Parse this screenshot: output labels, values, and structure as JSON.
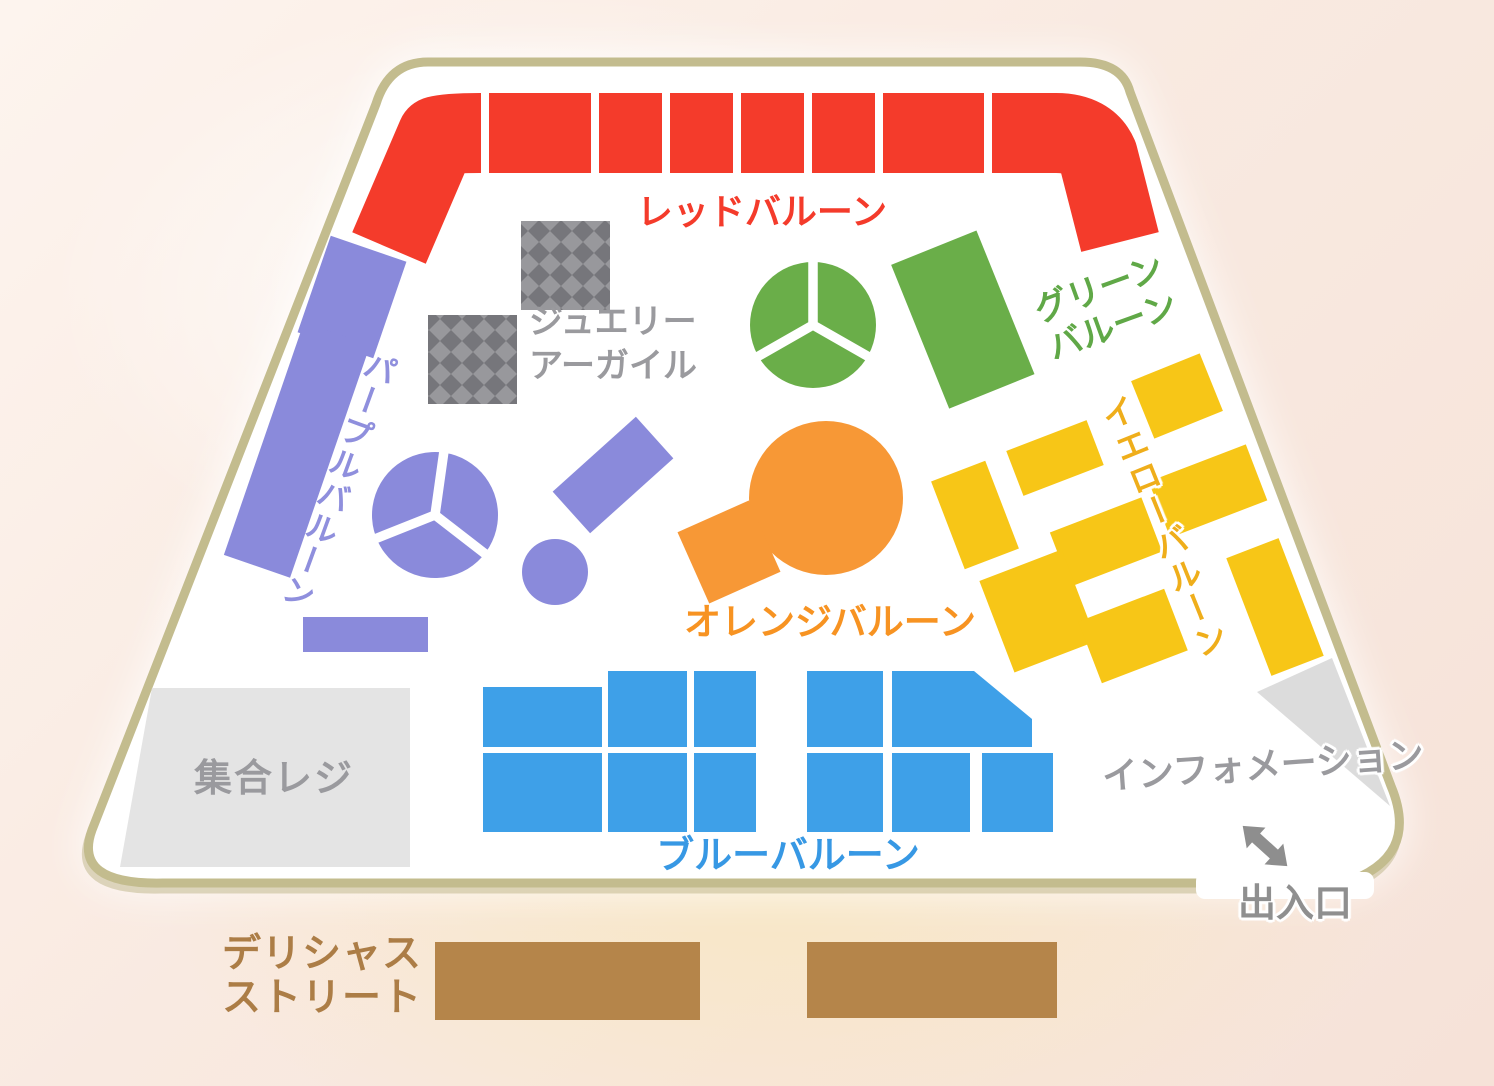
{
  "map": {
    "name": "store-floor-map",
    "zones": {
      "red": {
        "label": "レッドバルーン"
      },
      "purple": {
        "label": "パープルバルーン"
      },
      "green": {
        "label_line1": "グリーン",
        "label_line2": "バルーン"
      },
      "yellow": {
        "label": "イエローバルーン"
      },
      "orange": {
        "label": "オレンジバルーン"
      },
      "blue": {
        "label": "ブルーバルーン"
      },
      "jewelry_argyle": {
        "label_line1": "ジュエリー",
        "label_line2": "アーガイル"
      },
      "checkout": {
        "label": "集合レジ"
      },
      "information": {
        "label": "インフォメーション"
      },
      "entrance": {
        "label": "出入口",
        "icon": "double-headed-diagonal-arrow-icon"
      },
      "delicious_street": {
        "label_line1": "デリシャス",
        "label_line2": "ストリート"
      }
    },
    "colors": {
      "floor": "#ffffff",
      "floor_border": "#c3bc8e",
      "red": "#f43b2b",
      "purple": "#8a8adb",
      "purple_text": "#8f8fdd",
      "green": "#6aae49",
      "green_text": "#60a847",
      "yellow": "#f7c617",
      "yellow_text": "#efae1b",
      "orange": "#f79836",
      "orange_text": "#f79322",
      "blue": "#3ea0e8",
      "blue_text": "#3798e4",
      "brown": "#b5854a",
      "brown_text": "#ac7d46",
      "checkout_gray": "#e4e4e4",
      "wedge_gray": "#dcdcdc",
      "gray_text": "#9a9a9e",
      "gray_text_dark": "#8f8f8f",
      "argyle_light": "#98989c",
      "argyle_dark": "#76767b",
      "arrow_gray": "#8e8e8e"
    }
  }
}
